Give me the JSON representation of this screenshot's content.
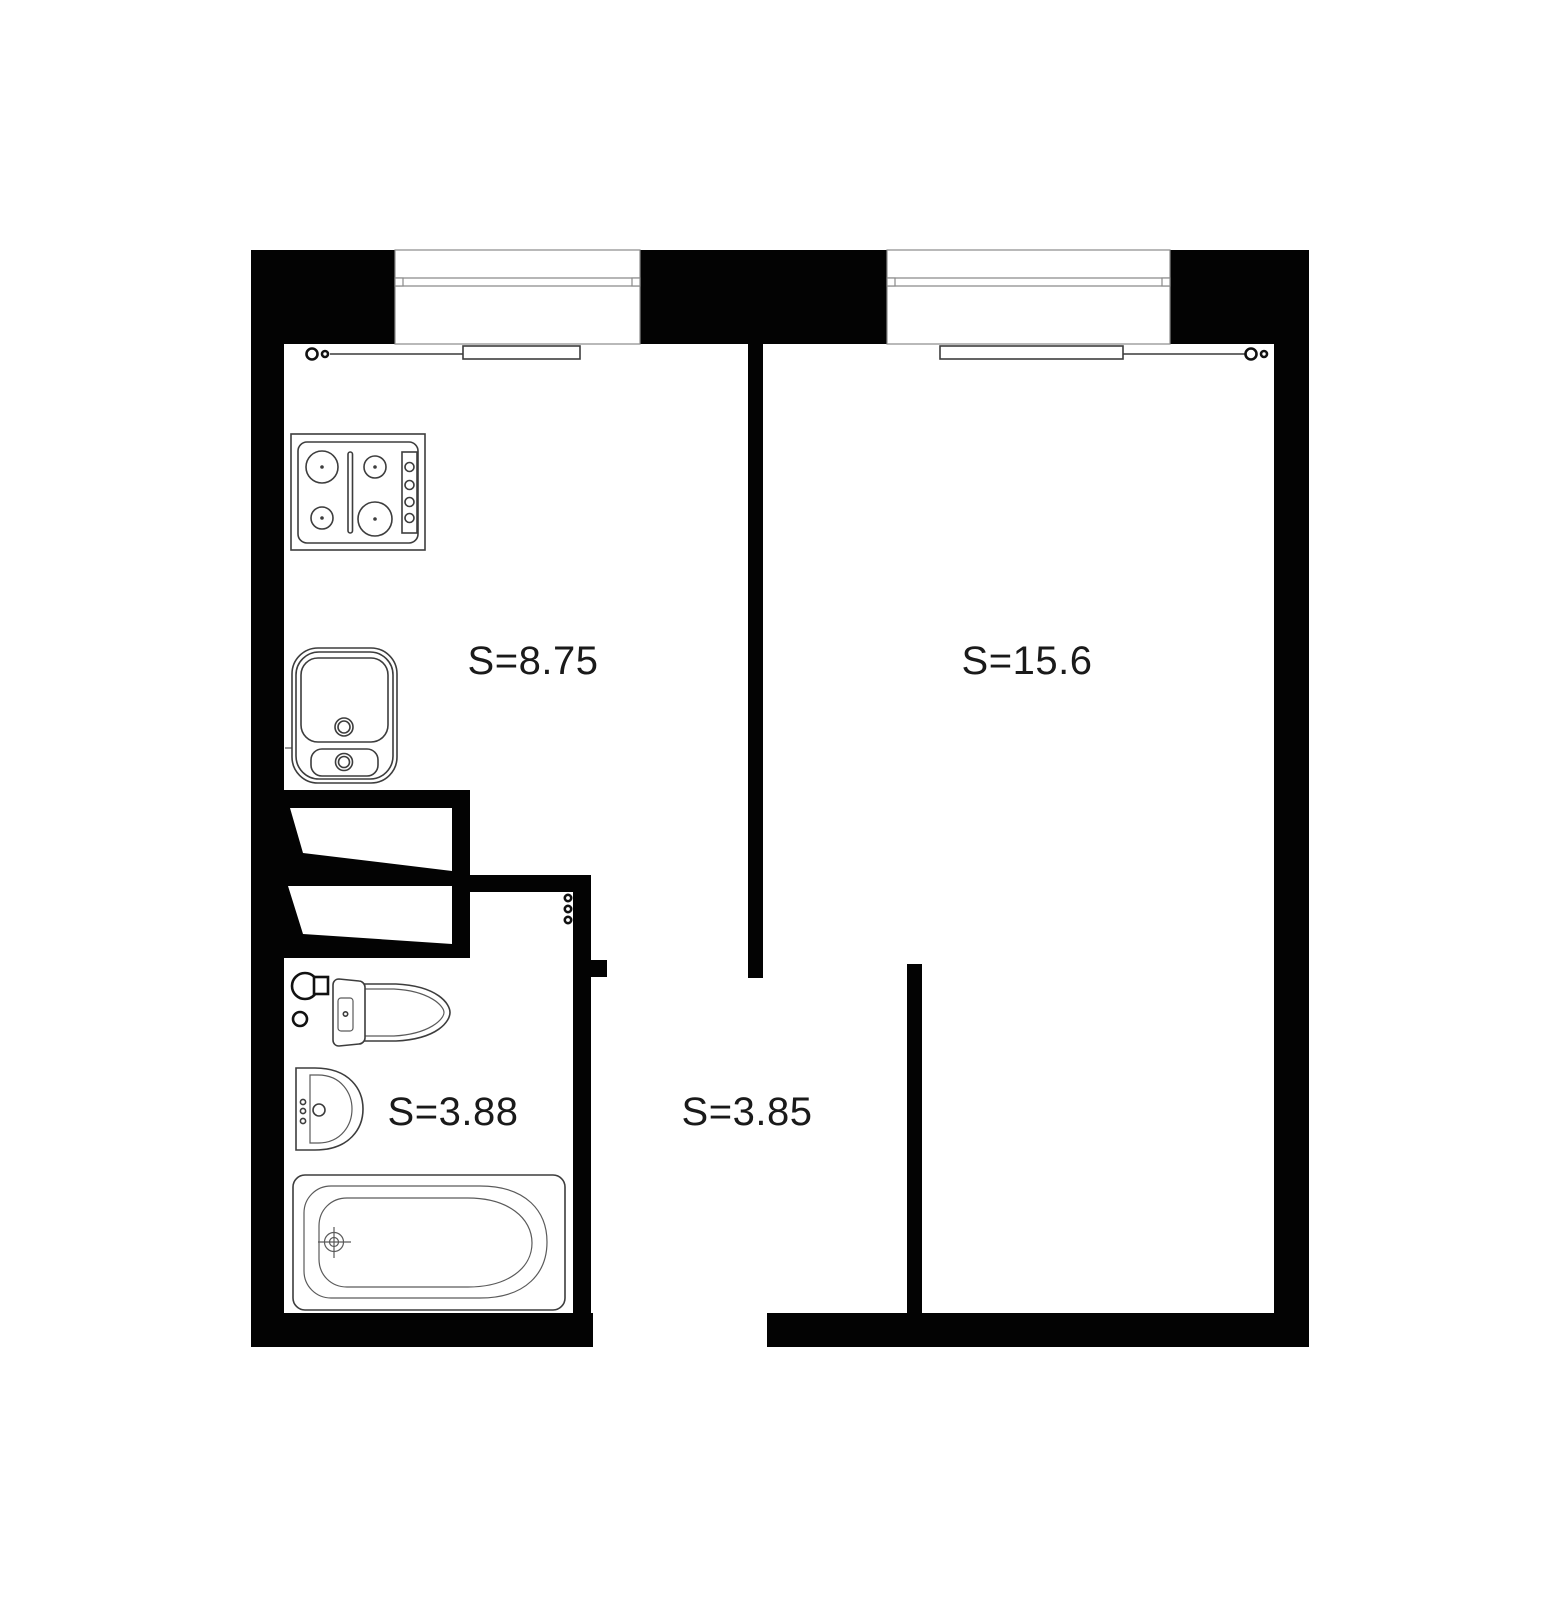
{
  "colors": {
    "wall": "#030303",
    "background": "#ffffff",
    "fixture_line": "#3d3d3d",
    "label_text": "#1a1a1a"
  },
  "rooms": {
    "kitchen": {
      "area_label": "S=8.75"
    },
    "living_room": {
      "area_label": "S=15.6"
    },
    "bathroom": {
      "area_label": "S=3.88"
    },
    "hallway": {
      "area_label": "S=3.85"
    }
  },
  "fixtures": {
    "kitchen": [
      "stove-icon",
      "kitchen-sink-icon",
      "radiator-icon",
      "window-icon"
    ],
    "living_room": [
      "radiator-icon",
      "window-icon"
    ],
    "bathroom": [
      "toilet-icon",
      "water-heater-icon",
      "washbasin-icon",
      "bathtub-icon"
    ],
    "closet": [
      "door-leaf-icon",
      "door-leaf-icon"
    ]
  }
}
